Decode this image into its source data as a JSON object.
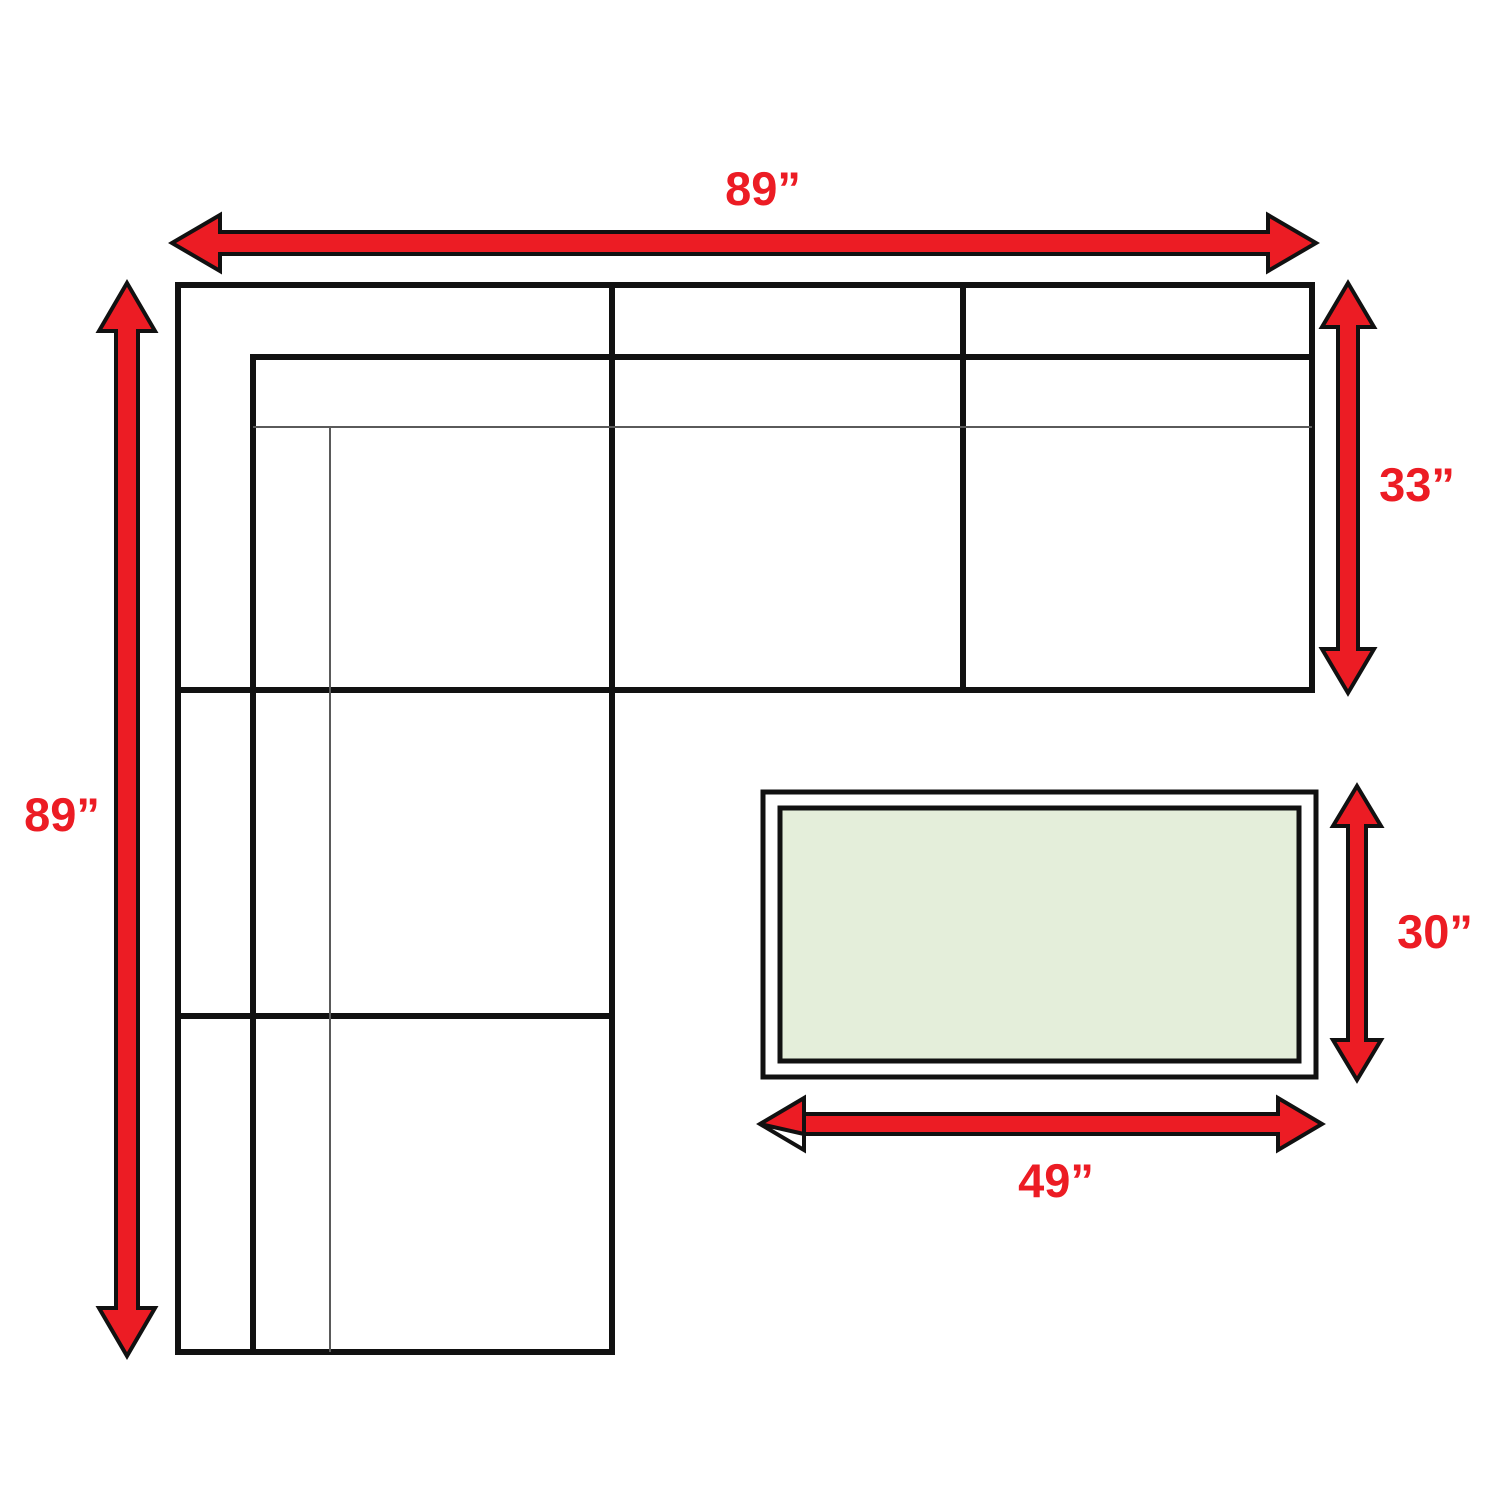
{
  "diagram": {
    "description": "Sectional sofa and table dimension diagram",
    "dimensions": {
      "sofa_width_top": "89”",
      "sofa_length_left": "89”",
      "sofa_depth_right": "33”",
      "table_depth": "30”",
      "table_width": "49”"
    },
    "colors": {
      "arrow_fill": "#ec1c24",
      "label_color": "#ec1c24",
      "outline_color": "#111111",
      "thin_line_color": "#5a5a5a",
      "table_fill": "#e4eeda",
      "background": "#ffffff"
    }
  }
}
